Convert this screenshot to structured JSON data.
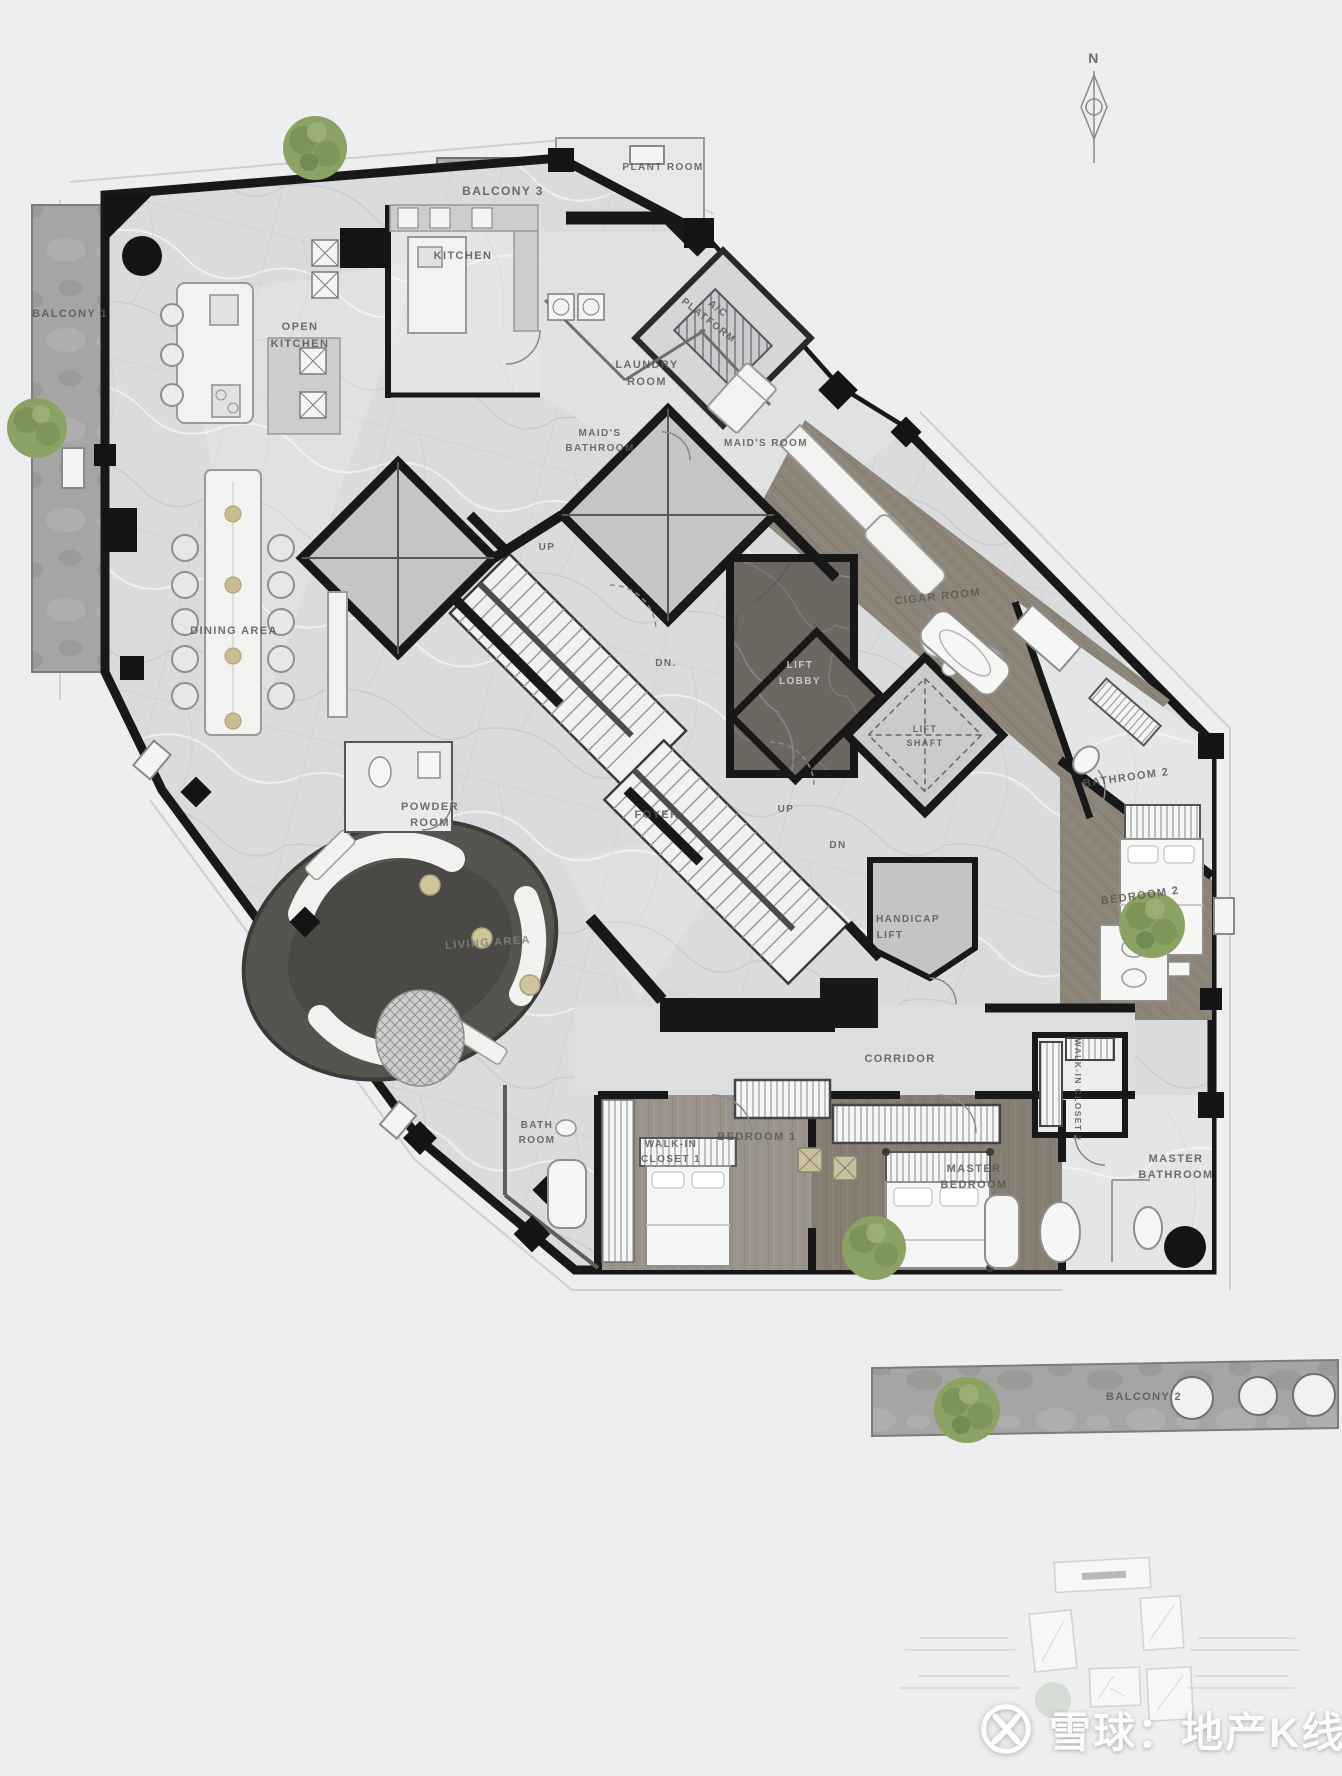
{
  "labels": {
    "plant_room": "PLANT ROOM",
    "balcony_1": "BALCONY 1",
    "balcony_2": "BALCONY 2",
    "balcony_3": "BALCONY 3",
    "kitchen": "KITCHEN",
    "open_kitchen": [
      "OPEN",
      "KITCHEN"
    ],
    "ac_platform": [
      "A/C",
      "PLATFORM"
    ],
    "laundry_room": [
      "LAUNDRY",
      "ROOM"
    ],
    "maids_bathroom": [
      "MAID'S",
      "BATHROOM"
    ],
    "maids_room": "MAID'S ROOM",
    "dining_area": "DINING AREA",
    "powder_room": [
      "POWDER",
      "ROOM"
    ],
    "foyer": "FOYER",
    "living_area": "LIVING AREA",
    "lift_lobby": [
      "LIFT",
      "LOBBY"
    ],
    "lift_shaft": [
      "LIFT",
      "SHAFT"
    ],
    "handicap_lift": [
      "HANDICAP",
      "LIFT"
    ],
    "cigar_room": "CIGAR ROOM",
    "bathroom_2": "BATHROOM 2",
    "bedroom_2": "BEDROOM 2",
    "corridor": "CORRIDOR",
    "walk_in_closet_1": [
      "WALK-IN",
      "CLOSET 1"
    ],
    "walk_in_closet_2": "WALK-IN CLOSET 2",
    "bath_room": [
      "BATH",
      "ROOM"
    ],
    "bedroom_1": "BEDROOM 1",
    "master_bedroom": [
      "MASTER",
      "BEDROOM"
    ],
    "master_bathroom": [
      "MASTER",
      "BATHROOM"
    ],
    "stair1_up": "UP",
    "stair1_dn": "DN.",
    "stair2_up": "UP",
    "stair2_dn": "DN"
  },
  "compass": {
    "north": "N"
  },
  "watermark": {
    "logo": "xueqiu-snowball-logo",
    "text": "雪球：地产K线"
  },
  "colors": {
    "background": "#edeef0",
    "marble_floor": "#d9dbdd",
    "dark_marble": "#6d6762",
    "wood_floor": "#8d8478",
    "sunken_living_ring": "#56544f",
    "walls": "#181818",
    "tree": "#8ba265",
    "label_text": "#585856",
    "watermark_text": "#fdfdfd"
  }
}
